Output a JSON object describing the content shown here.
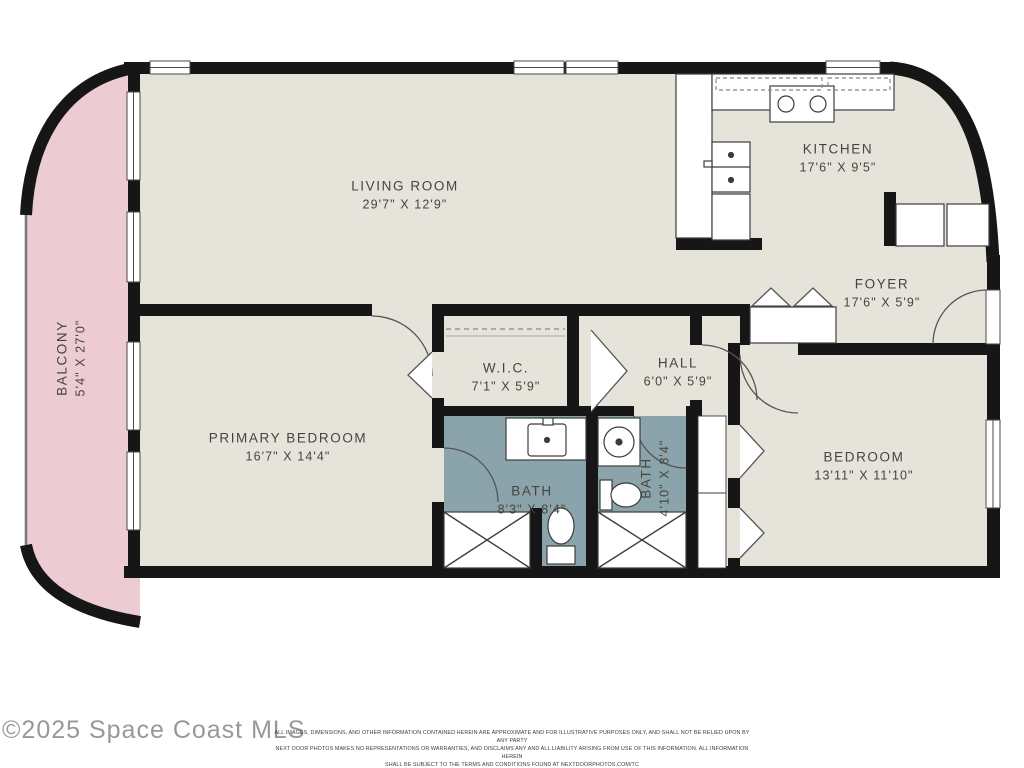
{
  "rooms": {
    "living_room": {
      "name": "LIVING ROOM",
      "dims": "29'7\" X 12'9\""
    },
    "kitchen": {
      "name": "KITCHEN",
      "dims": "17'6\" X 9'5\""
    },
    "foyer": {
      "name": "FOYER",
      "dims": "17'6\" X 5'9\""
    },
    "wic": {
      "name": "W.I.C.",
      "dims": "7'1\" X 5'9\""
    },
    "hall": {
      "name": "HALL",
      "dims": "6'0\" X 5'9\""
    },
    "primary_bedroom": {
      "name": "PRIMARY BEDROOM",
      "dims": "16'7\" X 14'4\""
    },
    "bath_primary": {
      "name": "BATH",
      "dims": "8'3\" X 8'4\""
    },
    "bath_hall": {
      "name": "BATH",
      "dims": "4'10\" X 8'4\""
    },
    "bedroom": {
      "name": "BEDROOM",
      "dims": "13'11\" X 11'10\""
    },
    "balcony": {
      "name": "BALCONY",
      "dims": "5'4\" X 27'0\""
    }
  },
  "footer": {
    "copyright": "©2025 Space Coast MLS",
    "disclaimer_lines": [
      "ALL IMAGES, DIMENSIONS, AND OTHER INFORMATION CONTAINED HEREIN ARE APPROXIMATE AND FOR ILLUSTRATIVE PURPOSES ONLY, AND SHALL NOT BE RELIED UPON BY ANY PARTY",
      "NEXT DOOR PHOTOS MAKES NO REPRESENTATIONS OR WARRANTIES, AND DISCLAIMS ANY AND ALL LIABILITY ARISING FROM USE OF THIS INFORMATION. ALL INFORMATION HEREIN",
      "SHALL BE SUBJECT TO THE TERMS AND CONDITIONS FOUND AT NEXTDOORPHOTOS.COM/TC"
    ]
  },
  "colors": {
    "wall": "#161616",
    "room_fill": "#e6e4da",
    "balcony_fill": "#ecccd2",
    "bath_fill": "#8ba4ab",
    "label_text": "#45453d"
  }
}
